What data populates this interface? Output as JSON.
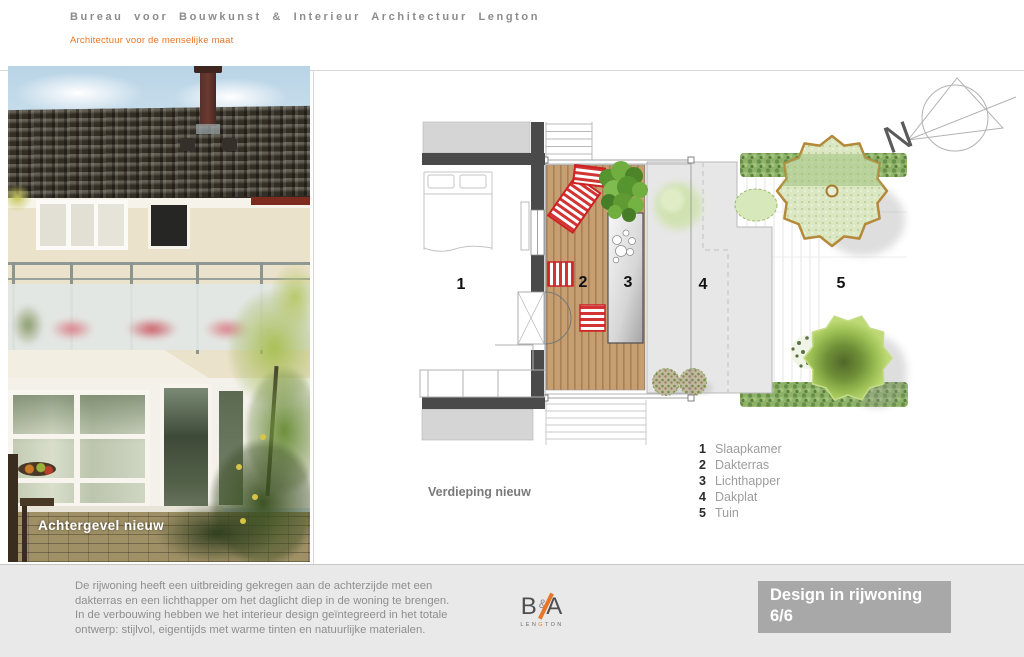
{
  "header": {
    "title": "Bureau voor Bouwkunst & Interieur Architectuur Lengton",
    "subtitle": "Architectuur voor de menselijke maat"
  },
  "photo": {
    "caption": "Achtergevel nieuw"
  },
  "plan": {
    "caption": "Verdieping nieuw",
    "compass": "N",
    "areas": [
      {
        "num": "1",
        "label": "Slaapkamer"
      },
      {
        "num": "2",
        "label": "Dakterras"
      },
      {
        "num": "3",
        "label": "Lichthapper"
      },
      {
        "num": "4",
        "label": "Dakplat"
      },
      {
        "num": "5",
        "label": "Tuin"
      }
    ]
  },
  "footer": {
    "description_lines": [
      "De rijwoning heeft een uitbreiding gekregen aan de achterzijde met een",
      "dakterras en een lichthapper om het daglicht diep in de woning te brengen.",
      "In de verbouwing hebben we het interieur design geïntegreerd in het totale",
      "ontwerp:  stijlvol, eigentijds met warme tinten en natuurlijke materialen."
    ],
    "logo": {
      "letter_b": "B",
      "ampersand": "&",
      "letter_a": "A",
      "sub_left": "LEN",
      "sub_accent": "G",
      "sub_right": "TON"
    },
    "project": {
      "title": "Design in rijwoning",
      "page": "6/6"
    }
  },
  "colors": {
    "accent_orange": "#e8762a",
    "title_gray": "#8c8c8c",
    "panel_gray": "#a8a8a8",
    "footer_bg": "#e9e9e9"
  }
}
